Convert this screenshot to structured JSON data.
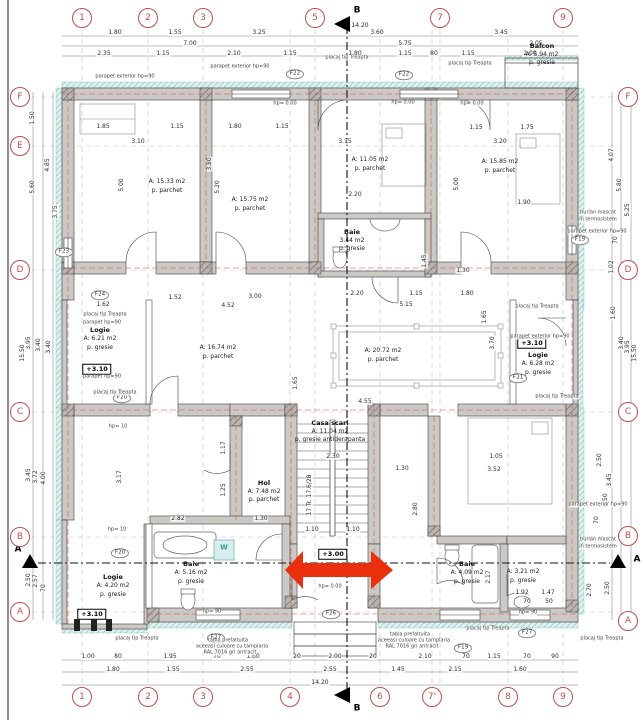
{
  "doc": {
    "type": "architectural floor plan",
    "total_width": "14.20",
    "total_height": "15.50"
  },
  "colors": {
    "grid_bubble": "#c0504d",
    "wall": "#ccc9c4",
    "insulation": "#56b1ac",
    "arrow": "#ea2f0d",
    "red_centerline": "#cc4b4b"
  },
  "grid": {
    "top_y": 18,
    "bottom_y": 697,
    "left_x": 20,
    "right_x": 628,
    "top": [
      {
        "x": 82,
        "label": "1"
      },
      {
        "x": 148,
        "label": "2"
      },
      {
        "x": 203,
        "label": "3"
      },
      {
        "x": 315,
        "label": "5"
      },
      {
        "x": 440,
        "label": "7"
      },
      {
        "x": 563,
        "label": "9"
      }
    ],
    "bottom": [
      {
        "x": 82,
        "label": "1"
      },
      {
        "x": 148,
        "label": "2"
      },
      {
        "x": 203,
        "label": "3"
      },
      {
        "x": 290,
        "label": "4"
      },
      {
        "x": 380,
        "label": "6"
      },
      {
        "x": 432,
        "label": "7'"
      },
      {
        "x": 508,
        "label": "8"
      },
      {
        "x": 563,
        "label": "9"
      }
    ],
    "left": [
      {
        "y": 97,
        "label": "F"
      },
      {
        "y": 146,
        "label": "E"
      },
      {
        "y": 270,
        "label": "D"
      },
      {
        "y": 412,
        "label": "C"
      },
      {
        "y": 537,
        "label": "B"
      },
      {
        "y": 612,
        "label": "A"
      }
    ],
    "right": [
      {
        "y": 97,
        "label": "F"
      },
      {
        "y": 270,
        "label": "D"
      },
      {
        "y": 412,
        "label": "C"
      },
      {
        "y": 536,
        "label": "B"
      },
      {
        "y": 621,
        "label": "A"
      }
    ]
  },
  "labels": [
    {
      "x": 18,
      "y": 550,
      "t": "A",
      "c": "sec"
    },
    {
      "x": 637,
      "y": 560,
      "t": "A",
      "c": "sec"
    },
    {
      "x": 357,
      "y": 11,
      "t": "B",
      "c": "sec"
    },
    {
      "x": 357,
      "y": 709,
      "t": "B",
      "c": "sec"
    },
    {
      "x": 115,
      "y": 33,
      "t": "1.80"
    },
    {
      "x": 175,
      "y": 33,
      "t": "1.55"
    },
    {
      "x": 259,
      "y": 33,
      "t": "3.25"
    },
    {
      "x": 377,
      "y": 33,
      "t": "3.60"
    },
    {
      "x": 501,
      "y": 33,
      "t": "3.45"
    },
    {
      "x": 190,
      "y": 44,
      "t": "7.00"
    },
    {
      "x": 405,
      "y": 44,
      "t": "5.75"
    },
    {
      "x": 536,
      "y": 44,
      "t": "2.05"
    },
    {
      "x": 360,
      "y": 26,
      "t": "14.20"
    },
    {
      "x": 104,
      "y": 54,
      "t": "2.35"
    },
    {
      "x": 163,
      "y": 54,
      "t": "1.15"
    },
    {
      "x": 234,
      "y": 54,
      "t": "2.10"
    },
    {
      "x": 290,
      "y": 54,
      "t": "1.15"
    },
    {
      "x": 355,
      "y": 54,
      "t": "1.80"
    },
    {
      "x": 405,
      "y": 54,
      "t": "1.15"
    },
    {
      "x": 434,
      "y": 54,
      "t": "80"
    },
    {
      "x": 468,
      "y": 54,
      "t": "1.15"
    },
    {
      "x": 530,
      "y": 54,
      "t": "2.00"
    },
    {
      "x": 88,
      "y": 657,
      "t": "1.00"
    },
    {
      "x": 118,
      "y": 657,
      "t": "80"
    },
    {
      "x": 170,
      "y": 657,
      "t": "1.95"
    },
    {
      "x": 217,
      "y": 657,
      "t": "70"
    },
    {
      "x": 253,
      "y": 657,
      "t": "1.60"
    },
    {
      "x": 297,
      "y": 657,
      "t": "20"
    },
    {
      "x": 335,
      "y": 657,
      "t": "2.00"
    },
    {
      "x": 373,
      "y": 657,
      "t": "20"
    },
    {
      "x": 425,
      "y": 657,
      "t": "2.10"
    },
    {
      "x": 466,
      "y": 657,
      "t": "70"
    },
    {
      "x": 494,
      "y": 657,
      "t": "1.15"
    },
    {
      "x": 527,
      "y": 657,
      "t": "70"
    },
    {
      "x": 555,
      "y": 657,
      "t": "90"
    },
    {
      "x": 113,
      "y": 670,
      "t": "1.80"
    },
    {
      "x": 173,
      "y": 670,
      "t": "1.55"
    },
    {
      "x": 247,
      "y": 670,
      "t": "2.55"
    },
    {
      "x": 330,
      "y": 670,
      "t": "2.55"
    },
    {
      "x": 398,
      "y": 670,
      "t": "1.45"
    },
    {
      "x": 455,
      "y": 670,
      "t": "2.15"
    },
    {
      "x": 520,
      "y": 670,
      "t": "1.60"
    },
    {
      "x": 320,
      "y": 683,
      "t": "14.20"
    },
    {
      "x": 33,
      "y": 118,
      "t": "1.50",
      "r": 1
    },
    {
      "x": 48,
      "y": 165,
      "t": "4.85",
      "r": 1
    },
    {
      "x": 33,
      "y": 187,
      "t": "5.60",
      "r": 1
    },
    {
      "x": 56,
      "y": 212,
      "t": "3.75",
      "r": 1
    },
    {
      "x": 29,
      "y": 343,
      "t": "3.95",
      "r": 1
    },
    {
      "x": 39,
      "y": 345,
      "t": "3.40",
      "r": 1
    },
    {
      "x": 49,
      "y": 347,
      "t": "3.40",
      "r": 1
    },
    {
      "x": 23,
      "y": 353,
      "t": "15.50",
      "r": 1
    },
    {
      "x": 29,
      "y": 475,
      "t": "3.45",
      "r": 1
    },
    {
      "x": 36,
      "y": 477,
      "t": "3.72",
      "r": 1
    },
    {
      "x": 44,
      "y": 478,
      "t": "4.00",
      "r": 1
    },
    {
      "x": 29,
      "y": 580,
      "t": "2.50",
      "r": 1
    },
    {
      "x": 36,
      "y": 581,
      "t": "2.57",
      "r": 1
    },
    {
      "x": 44,
      "y": 588,
      "t": "70",
      "r": 1
    },
    {
      "x": 612,
      "y": 155,
      "t": "4.07",
      "r": 1
    },
    {
      "x": 620,
      "y": 185,
      "t": "5.80",
      "r": 1
    },
    {
      "x": 628,
      "y": 210,
      "t": "5.25",
      "r": 1
    },
    {
      "x": 616,
      "y": 240,
      "t": "70",
      "r": 1
    },
    {
      "x": 612,
      "y": 267,
      "t": "1.02",
      "r": 1
    },
    {
      "x": 614,
      "y": 313,
      "t": "1.60",
      "r": 1
    },
    {
      "x": 622,
      "y": 343,
      "t": "3.40",
      "r": 1
    },
    {
      "x": 628,
      "y": 347,
      "t": "3.95",
      "r": 1
    },
    {
      "x": 635,
      "y": 353,
      "t": "15.50",
      "r": 1
    },
    {
      "x": 600,
      "y": 460,
      "t": "2.50",
      "r": 1
    },
    {
      "x": 610,
      "y": 480,
      "t": "3.45",
      "r": 1
    },
    {
      "x": 597,
      "y": 520,
      "t": "70",
      "r": 1
    },
    {
      "x": 606,
      "y": 500,
      "t": "6.50",
      "r": 1
    },
    {
      "x": 590,
      "y": 590,
      "t": "2.70",
      "r": 1
    },
    {
      "x": 608,
      "y": 588,
      "t": "2.50",
      "r": 1
    },
    {
      "x": 103,
      "y": 127,
      "t": "1.85"
    },
    {
      "x": 177,
      "y": 127,
      "t": "1.15"
    },
    {
      "x": 235,
      "y": 127,
      "t": "1.80"
    },
    {
      "x": 282,
      "y": 127,
      "t": "1.15"
    },
    {
      "x": 138,
      "y": 142,
      "t": "3.10"
    },
    {
      "x": 345,
      "y": 142,
      "t": "3.15"
    },
    {
      "x": 476,
      "y": 128,
      "t": "1.15"
    },
    {
      "x": 527,
      "y": 128,
      "t": "1.75"
    },
    {
      "x": 500,
      "y": 142,
      "t": "3.20"
    },
    {
      "x": 122,
      "y": 185,
      "t": "5.00",
      "r": 1
    },
    {
      "x": 210,
      "y": 164,
      "t": "3.80",
      "r": 1
    },
    {
      "x": 218,
      "y": 187,
      "t": "5.20",
      "r": 1
    },
    {
      "x": 457,
      "y": 184,
      "t": "5.00",
      "r": 1
    },
    {
      "x": 524,
      "y": 203,
      "t": "1.90"
    },
    {
      "x": 355,
      "y": 195,
      "t": "2.20"
    },
    {
      "x": 425,
      "y": 261,
      "t": "1.45",
      "r": 1
    },
    {
      "x": 463,
      "y": 271,
      "t": "1.30"
    },
    {
      "x": 103,
      "y": 305,
      "t": "1.62"
    },
    {
      "x": 175,
      "y": 298,
      "t": "1.52"
    },
    {
      "x": 255,
      "y": 297,
      "t": "3.00"
    },
    {
      "x": 228,
      "y": 306,
      "t": "4.52"
    },
    {
      "x": 357,
      "y": 294,
      "t": "2.20"
    },
    {
      "x": 416,
      "y": 294,
      "t": "1.15"
    },
    {
      "x": 467,
      "y": 294,
      "t": "1.80"
    },
    {
      "x": 406,
      "y": 305,
      "t": "5.15"
    },
    {
      "x": 485,
      "y": 317,
      "t": "1.65",
      "r": 1
    },
    {
      "x": 493,
      "y": 343,
      "t": "3.70",
      "r": 1
    },
    {
      "x": 365,
      "y": 402,
      "t": "4.55"
    },
    {
      "x": 296,
      "y": 383,
      "t": "1.65",
      "r": 1
    },
    {
      "x": 333,
      "y": 457,
      "t": "2.30"
    },
    {
      "x": 312,
      "y": 530,
      "t": "1.10"
    },
    {
      "x": 353,
      "y": 530,
      "t": "1.10"
    },
    {
      "x": 310,
      "y": 495,
      "t": "17 Tr. 17.6/28",
      "r": 1
    },
    {
      "x": 120,
      "y": 477,
      "t": "3.17",
      "r": 1
    },
    {
      "x": 178,
      "y": 519,
      "t": "2.82"
    },
    {
      "x": 224,
      "y": 448,
      "t": "1.17",
      "r": 1
    },
    {
      "x": 224,
      "y": 490,
      "t": "1.25",
      "r": 1
    },
    {
      "x": 261,
      "y": 519,
      "t": "1.30"
    },
    {
      "x": 494,
      "y": 470,
      "t": "3.52"
    },
    {
      "x": 496,
      "y": 457,
      "t": "1.05"
    },
    {
      "x": 416,
      "y": 509,
      "t": "2.80",
      "r": 1
    },
    {
      "x": 402,
      "y": 469,
      "t": "1.30"
    },
    {
      "x": 522,
      "y": 593,
      "t": "1.92"
    },
    {
      "x": 548,
      "y": 593,
      "t": "1.47"
    },
    {
      "x": 527,
      "y": 602,
      "t": "70"
    },
    {
      "x": 549,
      "y": 602,
      "t": "50"
    },
    {
      "x": 489,
      "y": 577,
      "t": "2.17",
      "r": 1
    },
    {
      "x": 167,
      "y": 182,
      "t": "A: 15.33 m2",
      "c": "ra"
    },
    {
      "x": 167,
      "y": 191,
      "t": "p. parchet",
      "c": "ra"
    },
    {
      "x": 250,
      "y": 200,
      "t": "A: 15.75 m2",
      "c": "ra"
    },
    {
      "x": 250,
      "y": 209,
      "t": "p. parchet",
      "c": "ra"
    },
    {
      "x": 370,
      "y": 160,
      "t": "A: 11.05 m2",
      "c": "ra"
    },
    {
      "x": 370,
      "y": 169,
      "t": "p. parchet",
      "c": "ra"
    },
    {
      "x": 500,
      "y": 162,
      "t": "A: 15.85 m2",
      "c": "ra"
    },
    {
      "x": 500,
      "y": 171,
      "t": "p. parchet",
      "c": "ra"
    },
    {
      "x": 542,
      "y": 46,
      "t": "Balcon",
      "c": "rn"
    },
    {
      "x": 542,
      "y": 55,
      "t": "A: 5.94 m2",
      "c": "ra"
    },
    {
      "x": 542,
      "y": 63,
      "t": "p. gresie",
      "c": "ra"
    },
    {
      "x": 352,
      "y": 232,
      "t": "Baie",
      "c": "rn"
    },
    {
      "x": 352,
      "y": 241,
      "t": "3.44 m2",
      "c": "ra"
    },
    {
      "x": 352,
      "y": 249,
      "t": "p. gresie",
      "c": "ra"
    },
    {
      "x": 100,
      "y": 330,
      "t": "Logie",
      "c": "rn"
    },
    {
      "x": 100,
      "y": 339,
      "t": "A: 6.21 m2",
      "c": "ra"
    },
    {
      "x": 100,
      "y": 348,
      "t": "p. gresie",
      "c": "ra"
    },
    {
      "x": 218,
      "y": 348,
      "t": "A: 16.74 m2",
      "c": "ra"
    },
    {
      "x": 218,
      "y": 357,
      "t": "p. parchet",
      "c": "ra"
    },
    {
      "x": 383,
      "y": 351,
      "t": "A: 20.72 m2",
      "c": "ra"
    },
    {
      "x": 383,
      "y": 360,
      "t": "p. parchet",
      "c": "ra"
    },
    {
      "x": 538,
      "y": 355,
      "t": "Logie",
      "c": "rn"
    },
    {
      "x": 538,
      "y": 364,
      "t": "A: 6.28 m2",
      "c": "ra"
    },
    {
      "x": 538,
      "y": 373,
      "t": "p. gresie",
      "c": "ra"
    },
    {
      "x": 330,
      "y": 423,
      "t": "Casa scari",
      "c": "rn"
    },
    {
      "x": 330,
      "y": 432,
      "t": "A: 11.04 m2",
      "c": "ra"
    },
    {
      "x": 330,
      "y": 440,
      "t": "p. gresie antiderapanta",
      "c": "ra"
    },
    {
      "x": 264,
      "y": 483,
      "t": "Hol",
      "c": "rn"
    },
    {
      "x": 264,
      "y": 492,
      "t": "A: 7.48 m2",
      "c": "ra"
    },
    {
      "x": 264,
      "y": 500,
      "t": "p. parchet",
      "c": "ra"
    },
    {
      "x": 191,
      "y": 564,
      "t": "Baie",
      "c": "rn"
    },
    {
      "x": 191,
      "y": 573,
      "t": "A: 5.16 m2",
      "c": "ra"
    },
    {
      "x": 191,
      "y": 582,
      "t": "p. gresie",
      "c": "ra"
    },
    {
      "x": 113,
      "y": 577,
      "t": "Logie",
      "c": "rn"
    },
    {
      "x": 113,
      "y": 586,
      "t": "A: 4.20 m2",
      "c": "ra"
    },
    {
      "x": 113,
      "y": 595,
      "t": "p. gresie",
      "c": "ra"
    },
    {
      "x": 467,
      "y": 564,
      "t": "Baie",
      "c": "rn"
    },
    {
      "x": 467,
      "y": 573,
      "t": "A: 4.09 m2",
      "c": "ra"
    },
    {
      "x": 467,
      "y": 582,
      "t": "p. gresie",
      "c": "ra"
    },
    {
      "x": 523,
      "y": 572,
      "t": "A: 3.21 m2",
      "c": "ra"
    },
    {
      "x": 523,
      "y": 581,
      "t": "p. gresie",
      "c": "ra"
    },
    {
      "x": 224,
      "y": 548,
      "t": "W",
      "c": "wm"
    },
    {
      "x": 97,
      "y": 369,
      "t": "+3.10",
      "c": "lvl"
    },
    {
      "x": 532,
      "y": 343,
      "t": "+3.10",
      "c": "lvl"
    },
    {
      "x": 92,
      "y": 614,
      "t": "+3.10",
      "c": "lvl"
    },
    {
      "x": 333,
      "y": 554,
      "t": "+3.00",
      "c": "lvl"
    },
    {
      "x": 295,
      "y": 74,
      "t": "F22",
      "c": "tag"
    },
    {
      "x": 404,
      "y": 75,
      "t": "F22",
      "c": "tag"
    },
    {
      "x": 64,
      "y": 252,
      "t": "F23",
      "c": "tag"
    },
    {
      "x": 100,
      "y": 295,
      "t": "F24",
      "c": "tag"
    },
    {
      "x": 122,
      "y": 398,
      "t": "F20",
      "c": "tag"
    },
    {
      "x": 120,
      "y": 553,
      "t": "F20",
      "c": "tag"
    },
    {
      "x": 518,
      "y": 378,
      "t": "F21",
      "c": "tag"
    },
    {
      "x": 331,
      "y": 614,
      "t": "F26",
      "c": "tag"
    },
    {
      "x": 216,
      "y": 638,
      "t": "F27",
      "c": "tag"
    },
    {
      "x": 527,
      "y": 633,
      "t": "F27",
      "c": "tag"
    },
    {
      "x": 463,
      "y": 648,
      "t": "F19",
      "c": "tag"
    },
    {
      "x": 580,
      "y": 240,
      "t": "F19",
      "c": "tag"
    },
    {
      "x": 125,
      "y": 77,
      "t": "parapet exterior hp=90",
      "c": "n"
    },
    {
      "x": 240,
      "y": 67,
      "t": "parapet exterior hp=90",
      "c": "n"
    },
    {
      "x": 347,
      "y": 58,
      "t": "placaj tip Treapta",
      "c": "n"
    },
    {
      "x": 470,
      "y": 64,
      "t": "placaj tip Treapta",
      "c": "n"
    },
    {
      "x": 598,
      "y": 213,
      "t": "burlan mascat",
      "c": "n"
    },
    {
      "x": 598,
      "y": 220,
      "t": "in termosistem",
      "c": "n"
    },
    {
      "x": 597,
      "y": 232,
      "t": "parapet exterior hp=90",
      "c": "n"
    },
    {
      "x": 105,
      "y": 315,
      "t": "placaj tip Treapta",
      "c": "n"
    },
    {
      "x": 102,
      "y": 323,
      "t": "parapet hp=90",
      "c": "n"
    },
    {
      "x": 115,
      "y": 393,
      "t": "placaj tip Treapta",
      "c": "n"
    },
    {
      "x": 537,
      "y": 307,
      "t": "placaj tip Treapta",
      "c": "n"
    },
    {
      "x": 540,
      "y": 337,
      "t": "parapet exterior hp=90",
      "c": "n"
    },
    {
      "x": 557,
      "y": 397,
      "t": "placaj tip Treapta",
      "c": "n"
    },
    {
      "x": 598,
      "y": 505,
      "t": "parapet exterior hp=90",
      "c": "n"
    },
    {
      "x": 598,
      "y": 540,
      "t": "burlan mascat",
      "c": "n"
    },
    {
      "x": 598,
      "y": 547,
      "t": "in termosistem",
      "c": "n"
    },
    {
      "x": 137,
      "y": 639,
      "t": "placaj tip Treapta",
      "c": "n"
    },
    {
      "x": 228,
      "y": 641,
      "t": "tabla prefaltuita",
      "c": "n"
    },
    {
      "x": 232,
      "y": 647,
      "t": "aceeasi culoare cu tamplaria",
      "c": "n"
    },
    {
      "x": 230,
      "y": 653,
      "t": "RAL 7016 gri antracit",
      "c": "n"
    },
    {
      "x": 410,
      "y": 635,
      "t": "tabla prefaltuita",
      "c": "n"
    },
    {
      "x": 414,
      "y": 641,
      "t": "aceeasi culoare cu tamplaria",
      "c": "n"
    },
    {
      "x": 412,
      "y": 647,
      "t": "RAL 7016 gri antracit",
      "c": "n"
    },
    {
      "x": 488,
      "y": 629,
      "t": "placaj tip Treapta",
      "c": "n"
    },
    {
      "x": 602,
      "y": 639,
      "t": "placaj tip Treapta",
      "c": "n"
    },
    {
      "x": 285,
      "y": 104,
      "t": "hp= 0.00",
      "c": "n"
    },
    {
      "x": 403,
      "y": 103,
      "t": "hp= 0.00",
      "c": "n"
    },
    {
      "x": 472,
      "y": 104,
      "t": "hp= 0.00",
      "c": "n"
    },
    {
      "x": 118,
      "y": 427,
      "t": "hp= 10",
      "c": "n"
    },
    {
      "x": 117,
      "y": 530,
      "t": "hp= 10",
      "c": "n"
    },
    {
      "x": 330,
      "y": 587,
      "t": "hp= 0.00",
      "c": "n"
    },
    {
      "x": 528,
      "y": 613,
      "t": "hp= 90",
      "c": "n"
    },
    {
      "x": 212,
      "y": 612,
      "t": "hp= 90",
      "c": "n"
    },
    {
      "x": 102,
      "y": 377,
      "t": "parapet hp=90",
      "c": "n"
    }
  ]
}
